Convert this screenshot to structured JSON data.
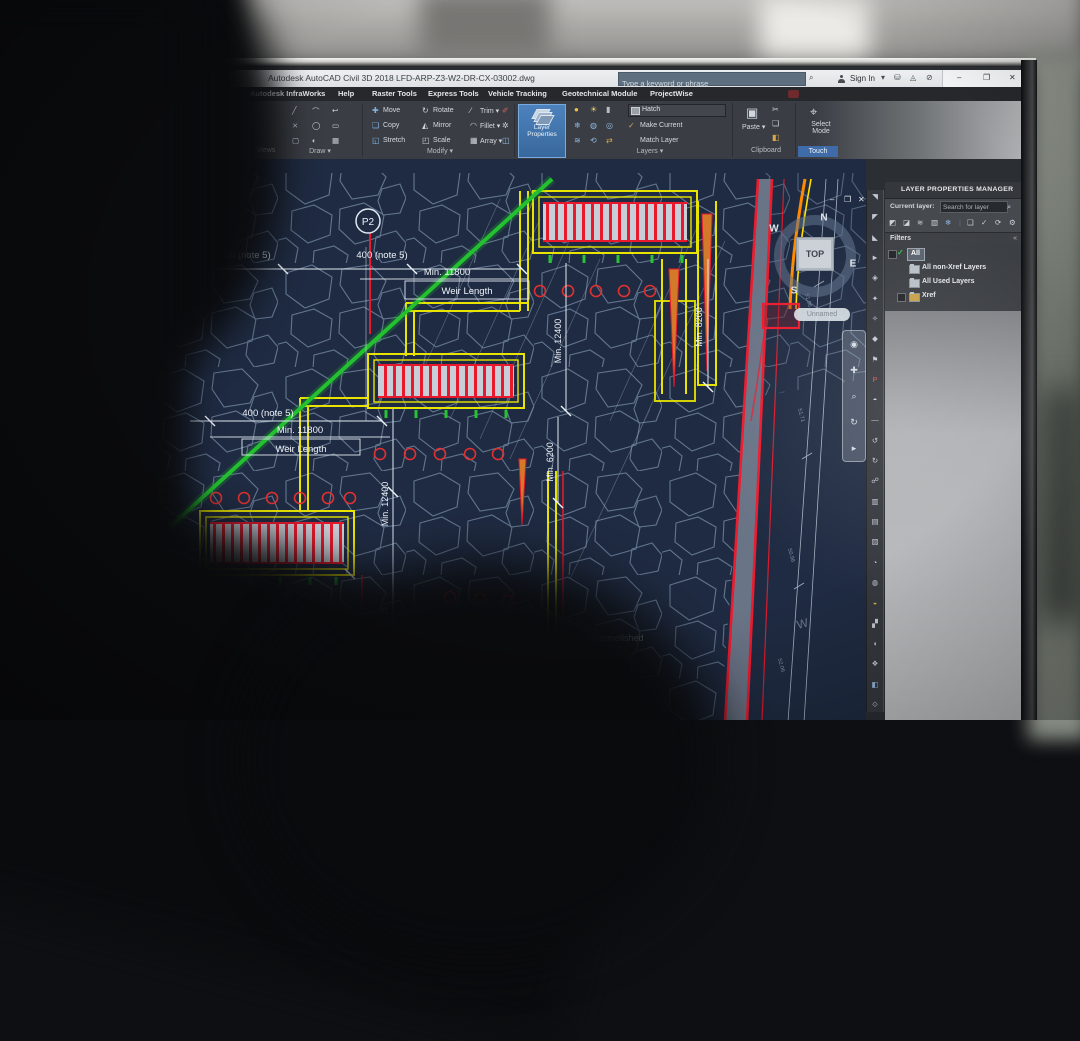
{
  "window": {
    "app_title": "Autodesk AutoCAD Civil 3D 2018    LFD-ARP-Z3-W2-DR-CX-03002.dwg",
    "search_placeholder": "Type a keyword or phrase",
    "sign_in_label": "Sign In",
    "minimize": "–",
    "restore": "❐",
    "close": "✕"
  },
  "menu": {
    "tabs": [
      "Autodesk InfraWorks",
      "Help",
      "Raster Tools",
      "Express Tools",
      "Vehicle Tracking",
      "Geotechnical Module",
      "ProjectWise"
    ]
  },
  "ribbon": {
    "views_label": "Views",
    "draw_label": "Draw ▾",
    "modify_label": "Modify ▾",
    "layers_label": "Layers ▾",
    "clipboard_label": "Clipboard",
    "touch_label": "Touch",
    "buttons": {
      "move": "Move",
      "copy": "Copy",
      "stretch": "Stretch",
      "rotate": "Rotate",
      "mirror": "Mirror",
      "scale": "Scale",
      "trim": "Trim ▾",
      "fillet": "Fillet ▾",
      "array": "Array ▾",
      "layer_properties": "Layer Properties",
      "hatch": "Hatch",
      "make_current": "Make Current",
      "match_layer": "Match Layer",
      "paste": "Paste ▾",
      "select_mode": "Select Mode"
    }
  },
  "palette": {
    "title": "LAYER PROPERTIES MANAGER",
    "current_layer_label": "Current layer:",
    "search_placeholder": "Search for layer",
    "filters_label": "Filters",
    "tree": {
      "all": "All",
      "non_xref": "All non-Xref Layers",
      "used": "All Used Layers",
      "xref": "Xref"
    }
  },
  "viewport": {
    "viewcube_label": "TOP",
    "compass_n": "N",
    "compass_e": "E",
    "compass_s": "S",
    "compass_w": "W",
    "pill_label": "Unnamed",
    "minimize": "–",
    "restore": "❐",
    "close": "✕"
  },
  "drawing": {
    "p2": "P2",
    "note400_a": "400 (note 5)",
    "note400_b": "400 (note 5)",
    "note400_c": "400 (note 5)",
    "min11800_a": "Min. 11800",
    "weir_length_a": "Weir Length",
    "min11800_b": "Min. 11800",
    "weir_length_b": "Weir Length",
    "min12400_a": "Min. 12400",
    "min6200_a": "Min. 6200",
    "min8200": "Min. 8200",
    "min12400_b": "Min. 12400",
    "min6200_b": "Min. 6200",
    "demolish_note": "Existing weir to be demolished",
    "w_mark": "W",
    "elev_a": "51.96",
    "elev_b": "51.71",
    "elev_c": "50.98",
    "elev_d": "52.06"
  },
  "colors": {
    "accent_blue": "#3f76b8",
    "cad_yellow": "#e8e400",
    "cad_red": "#e8192c",
    "cad_green": "#27c332",
    "canvas_bg": "#1f2b42",
    "hatch_line": "#7f95b0"
  }
}
